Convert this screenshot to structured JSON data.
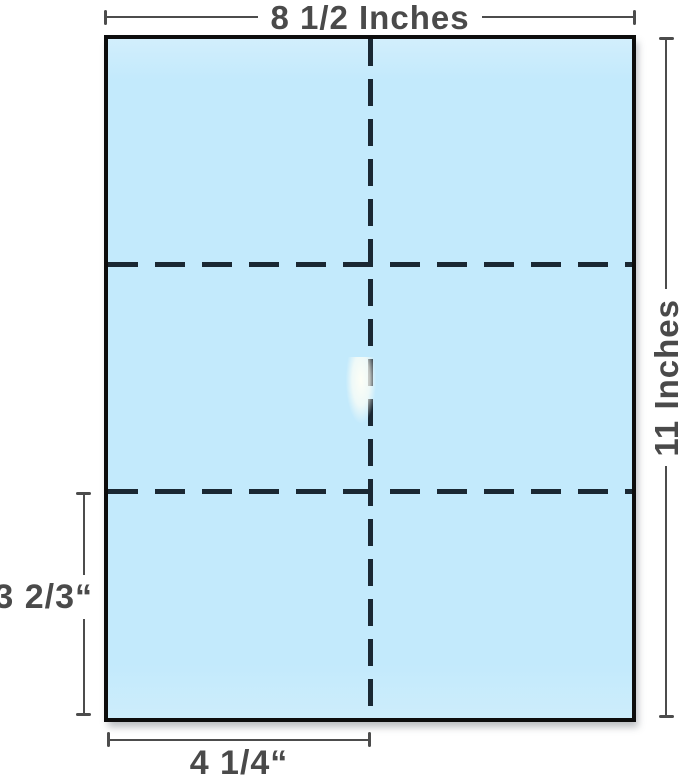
{
  "figure": {
    "labels": {
      "sheet_width": "8 1/2 Inches",
      "sheet_height": "11 Inches",
      "section_height": "3 2/3“",
      "section_width": "4 1/4“"
    },
    "grid": {
      "rows": 3,
      "columns": 2
    },
    "colors": {
      "paper-fill": "#c3eafc",
      "paper-border": "#0d0d0d",
      "dash": "#1a2833",
      "dim": "#4c4c4c",
      "dim-text": "#4a4a4a"
    }
  }
}
